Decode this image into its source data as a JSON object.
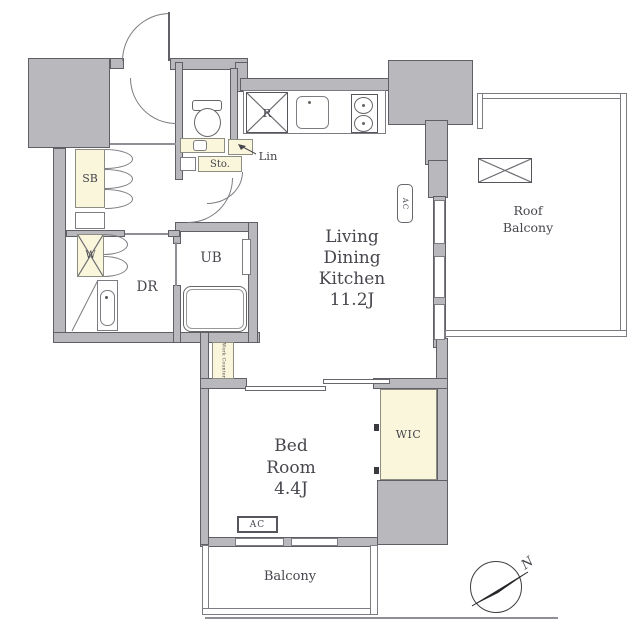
{
  "colors": {
    "wall_fill": "#b9b9bd",
    "wall_edge": "#5f5f66",
    "accent_fill": "#faf6db",
    "line": "#7c7c82",
    "text": "#46464d"
  },
  "plan": {
    "rooms": {
      "ldk": {
        "line1": "Living",
        "line2": "Dining",
        "line3": "Kitchen",
        "size": "11.2J"
      },
      "bedroom": {
        "line1": "Bed",
        "line2": "Room",
        "size": "4.4J"
      },
      "roof_balcony": {
        "line1": "Roof",
        "line2": "Balcony"
      },
      "balcony": {
        "label": "Balcony"
      },
      "wic": {
        "label": "WIC"
      },
      "unit_bath": {
        "label": "UB"
      },
      "dressing_room": {
        "label": "DR"
      },
      "shoe_box": {
        "label": "SB"
      },
      "washer": {
        "label": "W"
      },
      "storage": {
        "label": "Sto."
      },
      "linen": {
        "label": "Lin"
      },
      "refrigerator": {
        "label": "R"
      },
      "work_counter": {
        "label": "Work Counter"
      }
    },
    "equipment": {
      "ac": "AC"
    },
    "compass": {
      "north": "N"
    }
  }
}
